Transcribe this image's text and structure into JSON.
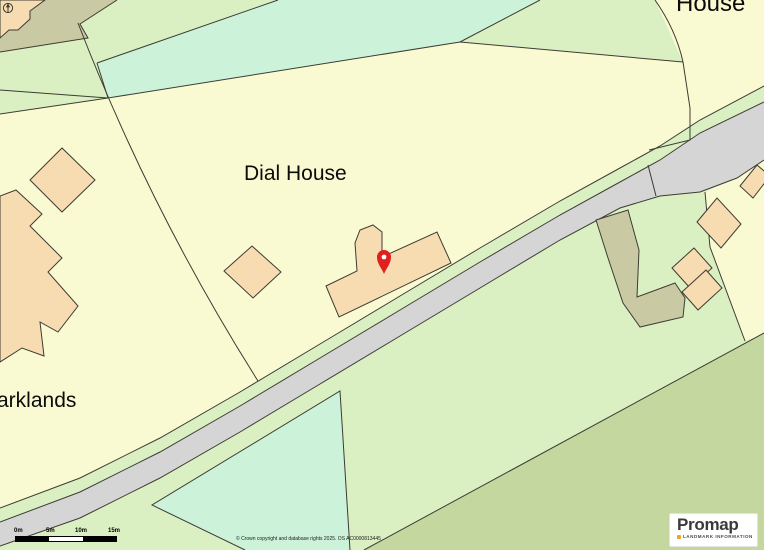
{
  "map": {
    "labels": {
      "dial_house": "Dial House",
      "house_partial": "House",
      "parklands_partial": "arklands"
    },
    "scale_bar": {
      "ticks": [
        "0m",
        "5m",
        "10m",
        "15m"
      ]
    },
    "copyright_notice": "© Crown copyright and database rights 2025. OS AC0000813445",
    "logo": {
      "brand": "Promap",
      "tagline": "LANDMARK INFORMATION"
    },
    "colors": {
      "parcel_yellow": "#fafad2",
      "parcel_green": "#dbf0c2",
      "parcel_teal": "#ccf2da",
      "parcel_olive": "#c9c9a4",
      "parcel_sage": "#c4d79f",
      "road_gray": "#d5d5d6",
      "building_peach": "#f8dcb1",
      "boundary_line": "#3c3c34",
      "pin_red": "#e01f1f",
      "pin_center_white": "#ffffff",
      "logo_orange": "#f0a030",
      "scale_black": "#000000"
    },
    "icons": {
      "pin": "location-pin-icon",
      "compass": "compass-icon"
    }
  }
}
